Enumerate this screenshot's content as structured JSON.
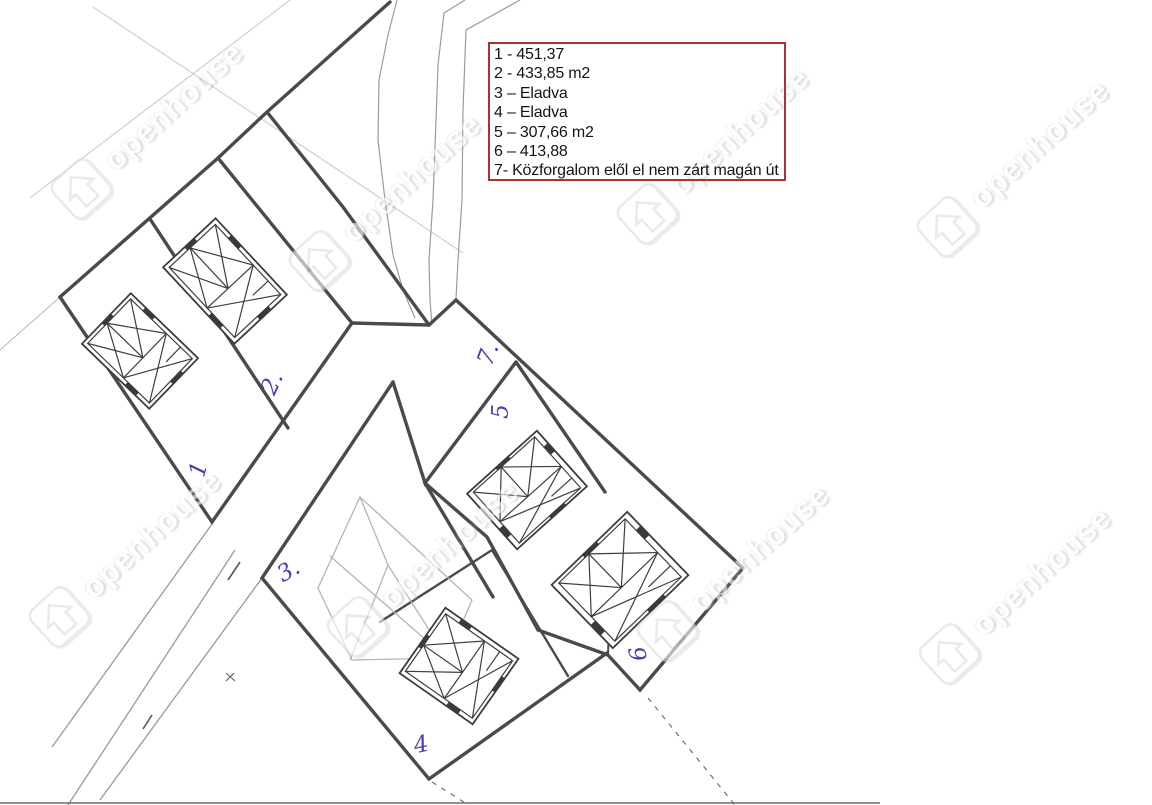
{
  "legend": {
    "items": [
      "1 - 451,37",
      "2 - 433,85 m2",
      "3 – Eladva",
      "4 – Eladva",
      "5 – 307,66 m2",
      "6 – 413,88",
      "7- Közforgalom elől el nem zárt magán út"
    ]
  },
  "parcel_labels": {
    "p1": "1",
    "p2": "2.",
    "p3": "3.",
    "p4": "4",
    "p5": "5",
    "p6": "6",
    "p7": "7."
  },
  "watermark": {
    "text": "openhouse"
  },
  "colors": {
    "legend_border": "#a93232",
    "label_ink": "#4a3fb0",
    "boundary_line": "#4a4a4a",
    "faint_line": "#c6c6c6"
  }
}
